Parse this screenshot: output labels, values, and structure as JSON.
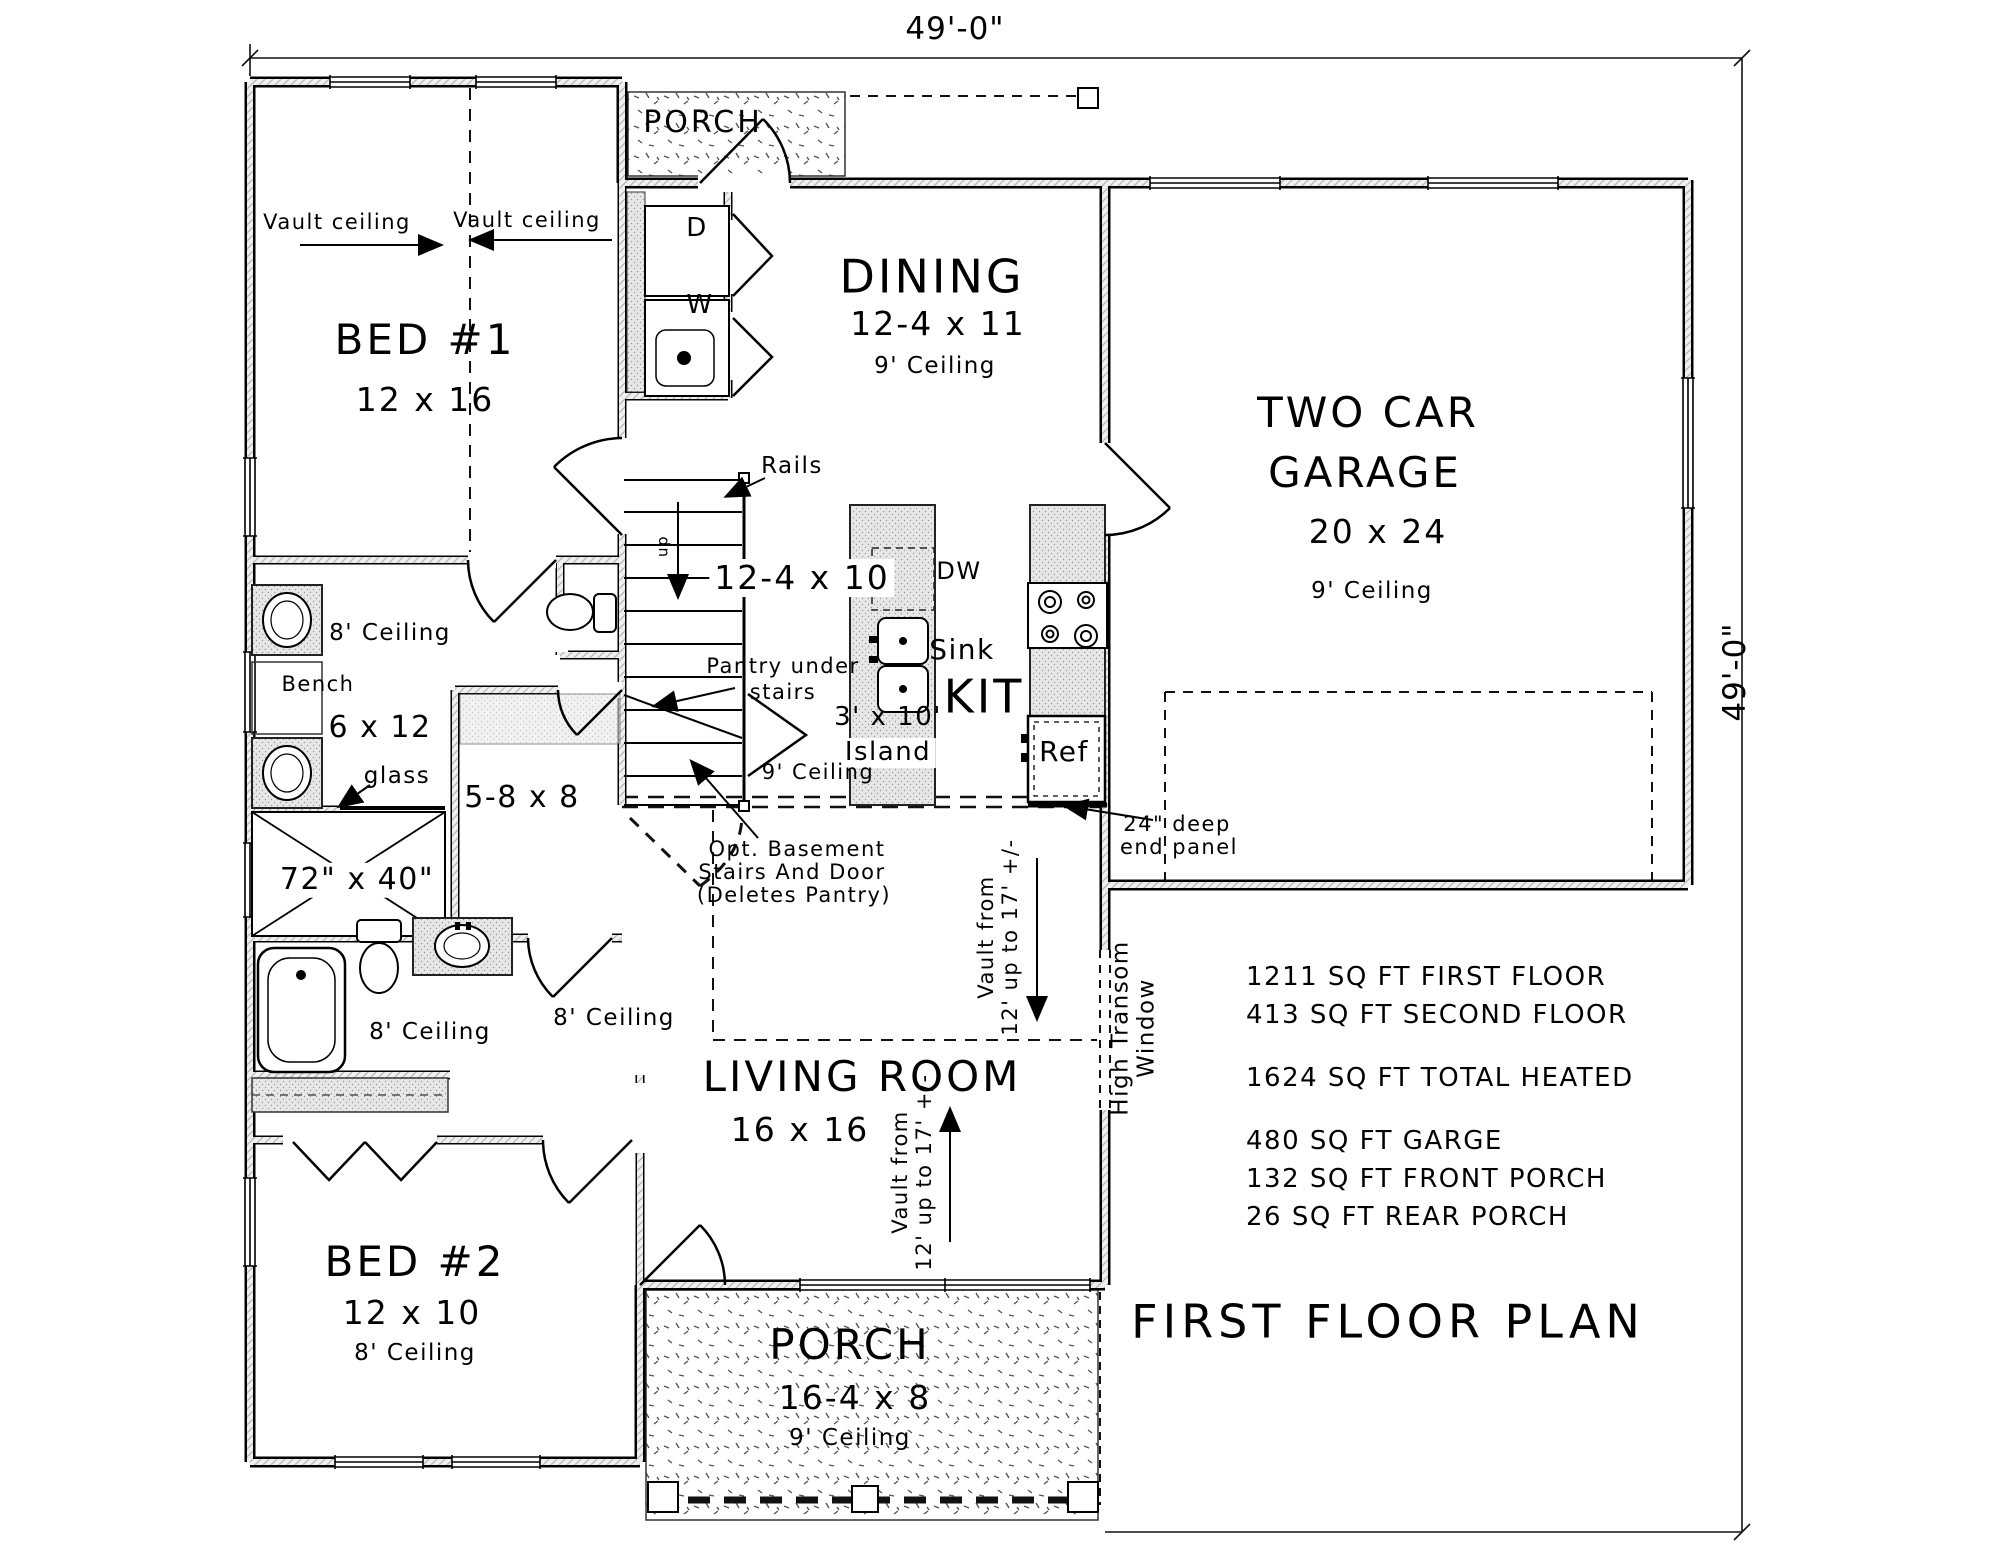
{
  "title": "FIRST FLOOR PLAN",
  "dimensions": {
    "width": "49'-0\"",
    "height": "49'-0\""
  },
  "rooms": {
    "porch_top": {
      "name": "PORCH"
    },
    "bed1": {
      "name": "BED #1",
      "size": "12 x 16"
    },
    "dining": {
      "name": "DINING",
      "size": "12-4 x 11",
      "ceiling": "9' Ceiling"
    },
    "garage": {
      "line1": "TWO CAR",
      "line2": "GARAGE",
      "size": "20 x 24",
      "ceiling": "9' Ceiling"
    },
    "kitchen": {
      "name": "KIT",
      "size": "12-4 x 10",
      "ceiling": "9' Ceiling",
      "island_size": "3' x 10'",
      "island_word": "Island",
      "sink": "Sink",
      "dw": "DW",
      "ref": "Ref"
    },
    "living": {
      "name": "LIVING ROOM",
      "size": "16 x 16"
    },
    "bed2": {
      "name": "BED #2",
      "size": "12 x 10",
      "ceiling": "8' Ceiling"
    },
    "porch_bottom": {
      "name": "PORCH",
      "size": "16-4 x 8",
      "ceiling": "9' Ceiling"
    },
    "master_bath": {
      "ceiling": "8' Ceiling",
      "bench": "Bench",
      "size": "6 x 12",
      "glass": "glass",
      "shower_size": "72\" x 40\""
    },
    "wic": {
      "size": "5-8 x 8"
    },
    "hall_bath": {
      "ceiling": "8' Ceiling"
    },
    "hall": {
      "ceiling": "8' Ceiling"
    }
  },
  "annotations": {
    "vault_left": "Vault ceiling",
    "vault_right": "Vault ceiling",
    "rails": "Rails",
    "up": "up",
    "dryer": "D",
    "washer": "W",
    "pantry_line1": "Pantry under",
    "pantry_line2": "stairs",
    "basement_line1": "Opt. Basement",
    "basement_line2": "Stairs And Door",
    "basement_line3": "(Deletes Pantry)",
    "end_panel_line1": "24\" deep",
    "end_panel_line2": "end panel",
    "vault_kitchen_line1": "Vault from",
    "vault_kitchen_line2": "12' up to 17' +/-",
    "vault_living_line1": "Vault from",
    "vault_living_line2": "12' up to 17' +/-",
    "transom_line1": "High Transom",
    "transom_line2": "Window"
  },
  "stats": {
    "lines": [
      "1211 SQ FT FIRST FLOOR",
      "413 SQ FT SECOND FLOOR",
      "1624 SQ FT TOTAL HEATED",
      "480 SQ FT GARGE",
      "132 SQ FT FRONT PORCH",
      "26 SQ FT REAR PORCH"
    ]
  }
}
